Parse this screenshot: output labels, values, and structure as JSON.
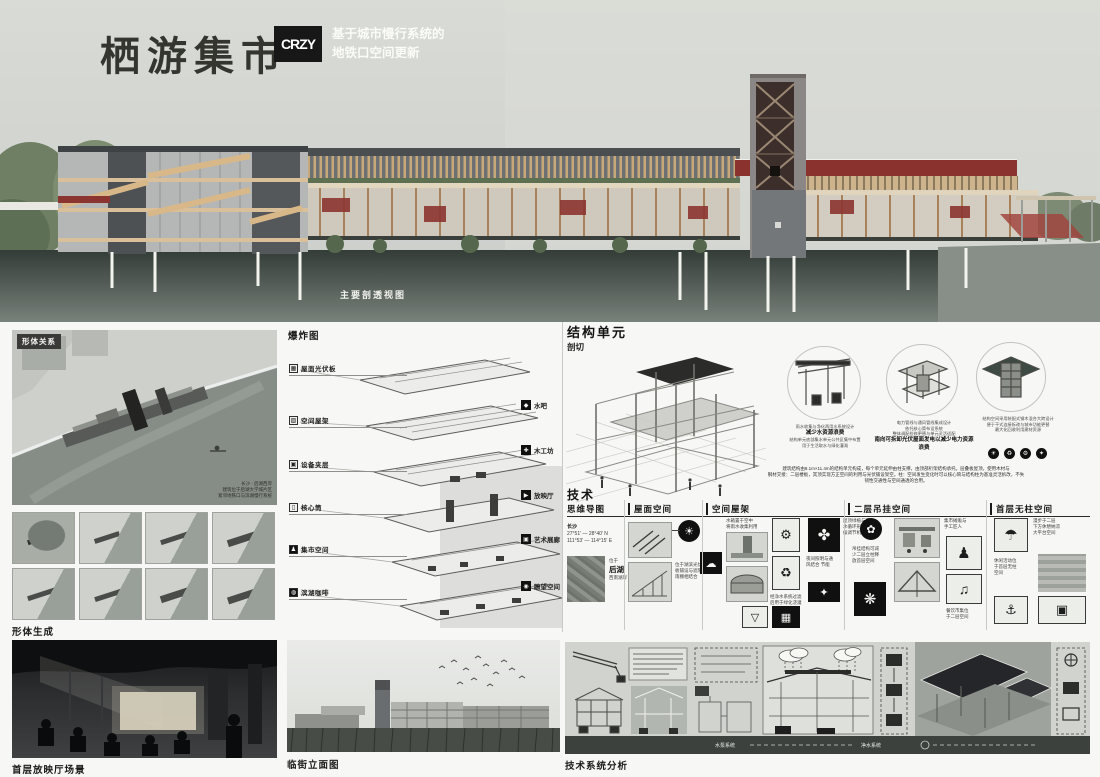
{
  "header": {
    "title": "栖游集市",
    "logo": "CRZY",
    "subtitle1": "基于城市慢行系统的",
    "subtitle2": "地铁口空间更新"
  },
  "main_render": {
    "caption": "主要剖透视图"
  },
  "form_relation": {
    "label": "形体关系",
    "note": "长沙 · 后湖西岸\n建筑位于后湖大学城片区\n紧邻地铁口与滨湖慢行系统"
  },
  "form_generation": {
    "label": "形体生成"
  },
  "exploded": {
    "title": "爆炸图",
    "left_labels": [
      "屋面光伏板",
      "空间屋架",
      "设备夹层",
      "核心筒",
      "集市空间",
      "滨湖咖啡"
    ],
    "right_labels": [
      "水吧",
      "木工坊",
      "放映厅",
      "艺术展廊",
      "瞭望空间"
    ]
  },
  "structure": {
    "title": "结构单元",
    "subtitle": "剖切",
    "circle1": {
      "l1": "雨水收集与净化两用水系统设计",
      "l2": "减少水资源浪费",
      "l3": "结构单元底部集水单元公共区集中布置\n用于生活取水与绿化灌溉"
    },
    "circle2": {
      "l1": "电力管线与通风管线集成设计\n依托核心筒布设系统\n整体调配检修更替与单元灵活适配",
      "l2": "南向可拆卸光伏屋面发电以减少电力资源浪费",
      "l3": ""
    },
    "circle3": {
      "l1": "结构空间采用装配式钢木混合大跨设计\n便于干式连接拆改与城市功能更替\n最大化回收利用建材资源",
      "l2": "",
      "l3": ""
    },
    "desc": "建筑结构由8.1m×11.4m的结构单元构成，每个单元延伸由柱支撑，由顶部桁架结构承托。层叠板屋顶，使用木材与\n钢材交接：二层楼板，其顶实现方正空间的利用与光伏铺设架空。柱：空间发生变化时可以核心筒与结构柱为基准灵活拆改，不失\n韧性交通性与空间通透的合用。"
  },
  "technology": {
    "title": "技术",
    "col1": "思维导图",
    "col2": "屋面空间",
    "col3": "空间屋架",
    "col4": "二层吊挂空间",
    "col5": "首层无柱空间",
    "mind": {
      "city": "长沙",
      "lat": "27°51′ — 28°40′ N",
      "lon": "111°53′ — 114°15′ E",
      "loc1": "位于",
      "loc2": "后湖",
      "loc3": "西南湖岸"
    },
    "roof_cap1": "位于湖滨光伏\n板铺设与遮阳\n雨棚相结合",
    "truss_cap1": "水箱置于空中\n将雨水收集利用",
    "truss_cap2": "经净水系统过滤\n后用于绿化浇灌",
    "truss_cap3": "屋顶绿植与雨\n水循环形成气\n候调节机制",
    "truss_cap4": "夜间照明与通\n风结合 节能",
    "hang_cap1": "吊挂结构可减\n少二层立柱释\n放首层空间",
    "hang_cap2": "集市摊贩与\n手工匠人",
    "hang_cap3": "餐饮市集位\n于二层空间",
    "free_cap1": "漫步于二层\n下方休憩纳凉\n大平台空间",
    "free_cap2": "休闲活动位\n于首层无柱\n空间"
  },
  "bottom": {
    "scene_caption": "首层放映厅场景",
    "elevation_caption": "临街立面图",
    "tech_caption": "技术系统分析",
    "tech_band1": "水泵系统",
    "tech_band2": "净水系统"
  },
  "icons": {
    "sun": "☀",
    "rain_cloud": "☁",
    "pump": "⚙",
    "recycle": "♻",
    "plants": "✤",
    "lamp": "✦",
    "funnel": "▽",
    "solar_panel": "▦",
    "corn": "✿",
    "grapes": "❋",
    "market_people": "♟",
    "drummer": "♫",
    "umbrella": "☂",
    "boat": "⚓",
    "stage": "▣",
    "exp_r1": "◆",
    "exp_r2": "✚",
    "exp_r3": "▶",
    "exp_r4": "▣",
    "exp_r5": "◉",
    "badge1": "☀",
    "badge2": "♻",
    "badge3": "⚙",
    "badge4": "✦"
  }
}
